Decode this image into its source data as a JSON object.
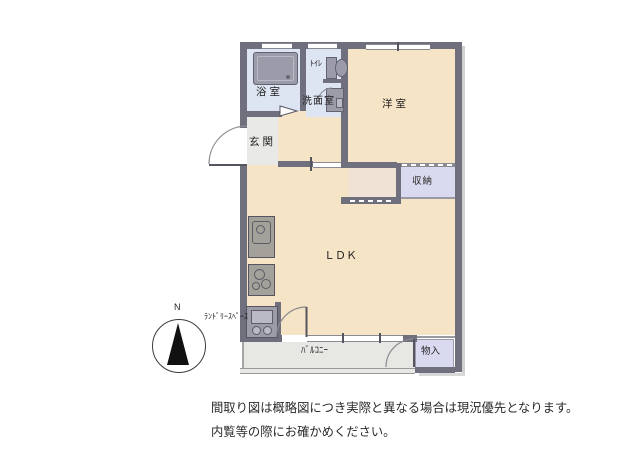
{
  "floorplan": {
    "compass_label": "N",
    "rooms": {
      "bathroom": "浴室",
      "toilet": "ﾄｲﾚ",
      "washroom": "洗面室",
      "western_room": "洋室",
      "entrance": "玄関",
      "storage": "収納",
      "ldk": "ＬＤＫ",
      "laundry_space": "ﾗﾝﾄﾞﾘｰｽﾍﾟｰｽ",
      "balcony": "ﾊﾞﾙｺﾆｰ",
      "closet": "物入"
    }
  },
  "disclaimer": {
    "line1": "間取り図は概略図につき実際と異なる場合は現況優先となります。",
    "line2": "内覧等の際にお確かめください。"
  },
  "colors": {
    "wall": "#6f6f7d",
    "floor-beige": "#f6e4c6",
    "floor-wet": "#dde4f2",
    "floor-closet": "#d9daef",
    "floor-closet-b": "#f0e2d4",
    "floor-entrance": "#e9e9e7",
    "floor-balcony": "#e7e7e4",
    "fixture": "#9b9baa",
    "fixture-light": "#b9bac6",
    "line": "#8a8a92",
    "text": "#1f1f1f"
  }
}
